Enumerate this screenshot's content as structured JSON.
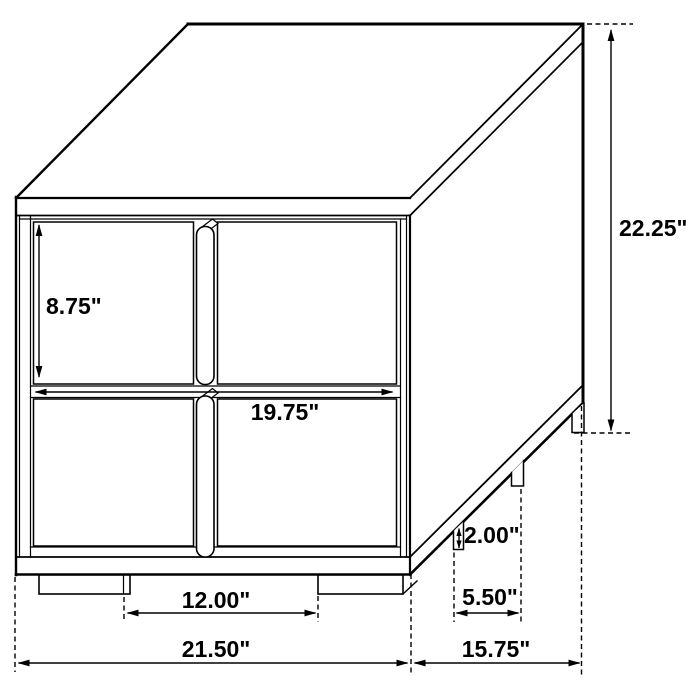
{
  "diagram": {
    "kind": "furniture-dimension-drawing",
    "item": "two-drawer-nightstand-isometric",
    "background_color": "#ffffff",
    "line_color": "#000000"
  },
  "dims": {
    "drawer_height": "8.75\"",
    "overall_height": "22.25\"",
    "drawer_width": "19.75\"",
    "foot_height": "2.00\"",
    "side_foot_spacing": "5.50\"",
    "front_foot_spacing": "12.00\"",
    "overall_width": "21.50\"",
    "overall_depth": "15.75\""
  }
}
